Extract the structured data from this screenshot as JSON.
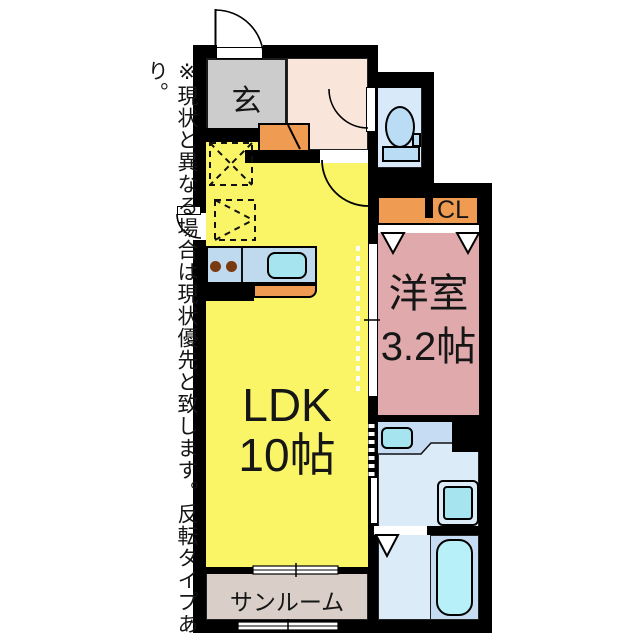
{
  "disclaimer": "※現状と異なる場合は現状優先と致します。反転タイプあり。",
  "rooms": {
    "genkan_label": "玄",
    "ldk_label": "LDK",
    "ldk_size": "10帖",
    "western_label": "洋室",
    "western_size": "3.2帖",
    "closet_label": "CL",
    "sunroom_label": "サンルーム"
  },
  "colors": {
    "wall": "#000000",
    "ldk": "#F9F567",
    "genkan": "#CCCCCC",
    "hallway": "#FAE5DB",
    "accent_orange": "#EF9B52",
    "western_room": "#E0A9AC",
    "toilet_room": "#D8E9F9",
    "fixture_blue": "#BBDCF5",
    "water_room": "#DCEBF8",
    "water_band": "#C6DCF2",
    "cyan_fixture": "#A6E4F0",
    "bathtub": "#B7F0F9",
    "sunroom": "#DACFC8",
    "counter": "#BFD9EE",
    "burner": "#7A3A10"
  }
}
